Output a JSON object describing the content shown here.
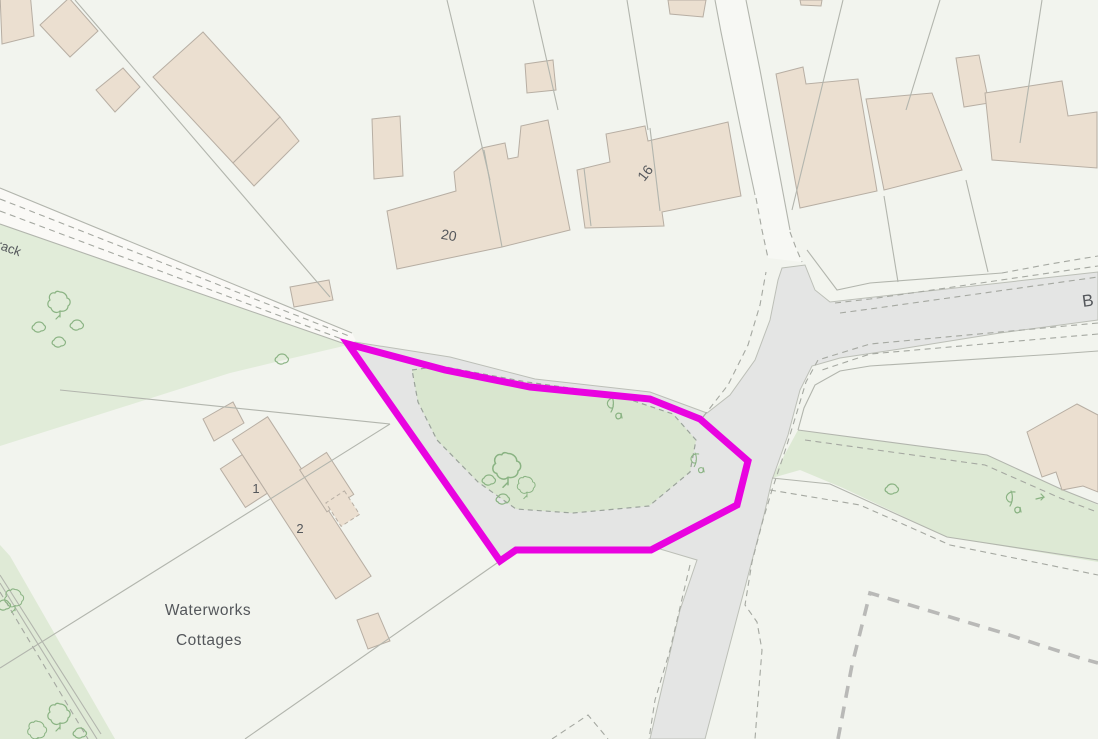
{
  "map": {
    "description": "Large-scale OS-style planning map with magenta site boundary around a green road-junction island",
    "labels": {
      "track_partial": "rack",
      "b_road_partial": "B",
      "house_20": "20",
      "house_16": "16",
      "cottage_1": "1",
      "cottage_2": "2",
      "waterworks_line1": "Waterworks",
      "waterworks_line2": "Cottages"
    },
    "site": {
      "boundary_points": "348,344 445,370 530,387 650,399 700,419 748,461 737,505 651,550 516,550 500,561",
      "boundary_color": "#e903e0"
    },
    "colors": {
      "background": "#f2f4ee",
      "road_fill": "#e4e5e4",
      "track_fill": "#faf9f6",
      "green_field": "#e1ecd9",
      "green_island": "#d9e6cf",
      "green_verge": "#dde9d4",
      "building_fill": "#ebdfd0",
      "building_stroke": "#b7aea3",
      "parcel_line": "#b2b5ad",
      "dashed_line": "#a5a8a1",
      "bold_boundary_dash": "#b9b9b7",
      "label_text": "#54575b",
      "tree_symbol": "#8ab383",
      "site_boundary": "#e903e0"
    }
  }
}
